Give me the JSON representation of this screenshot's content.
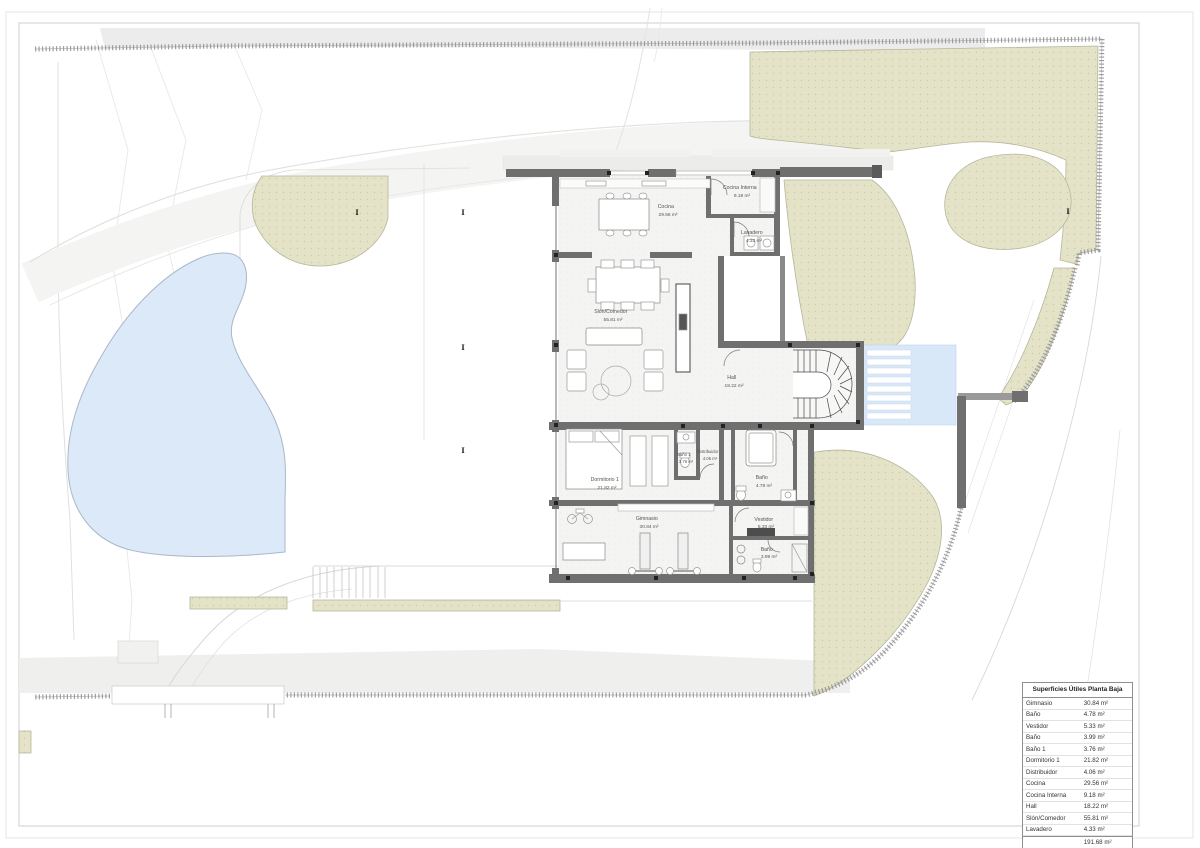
{
  "drawing": {
    "type": "architectural-site-and-floor-plan",
    "rooms": [
      {
        "name": "Cocina",
        "area": "29.56 m²"
      },
      {
        "name": "Cocina Interna",
        "area": "9.18 m²"
      },
      {
        "name": "Lavadero",
        "area": "4.33 m²"
      },
      {
        "name": "Slón/Comedor",
        "area": "55.81 m²"
      },
      {
        "name": "Hall",
        "area": "18.22 m²"
      },
      {
        "name": "Dormitorio 1",
        "area": "21.82 m²"
      },
      {
        "name": "Baño 1",
        "area": "3.76 m²"
      },
      {
        "name": "Distribuidor",
        "area": "4.06 m²"
      },
      {
        "name": "Baño",
        "area": "4.78 m²"
      },
      {
        "name": "Gimnasio",
        "area": "30.84 m²"
      },
      {
        "name": "Vestidor",
        "area": "5.33 m²"
      },
      {
        "name": "Baño",
        "area": "3.99 m²"
      }
    ],
    "areas_table": {
      "title": "Superficies Útiles Planta Baja",
      "rows": [
        {
          "label": "Gimnasio",
          "value": "30.84 m²"
        },
        {
          "label": "Baño",
          "value": "4.78 m²"
        },
        {
          "label": "Vestidor",
          "value": "5.33 m²"
        },
        {
          "label": "Baño",
          "value": "3.99 m²"
        },
        {
          "label": "Baño 1",
          "value": "3.76 m²"
        },
        {
          "label": "Dormitorio 1",
          "value": "21.82 m²"
        },
        {
          "label": "Distribuidor",
          "value": "4.06 m²"
        },
        {
          "label": "Cocina",
          "value": "29.56 m²"
        },
        {
          "label": "Cocina Interna",
          "value": "9.18 m²"
        },
        {
          "label": "Hall",
          "value": "18.22 m²"
        },
        {
          "label": "Slón/Comedor",
          "value": "55.81 m²"
        },
        {
          "label": "Lavadero",
          "value": "4.33 m²"
        }
      ],
      "total_value": "191.68 m²"
    },
    "palette": {
      "wall": "#6f6f6f",
      "vegetation": "#e4e3c8",
      "pond_water": "#dbe9f8",
      "pool_water": "#d9e8f8",
      "road": "#efefee"
    }
  }
}
